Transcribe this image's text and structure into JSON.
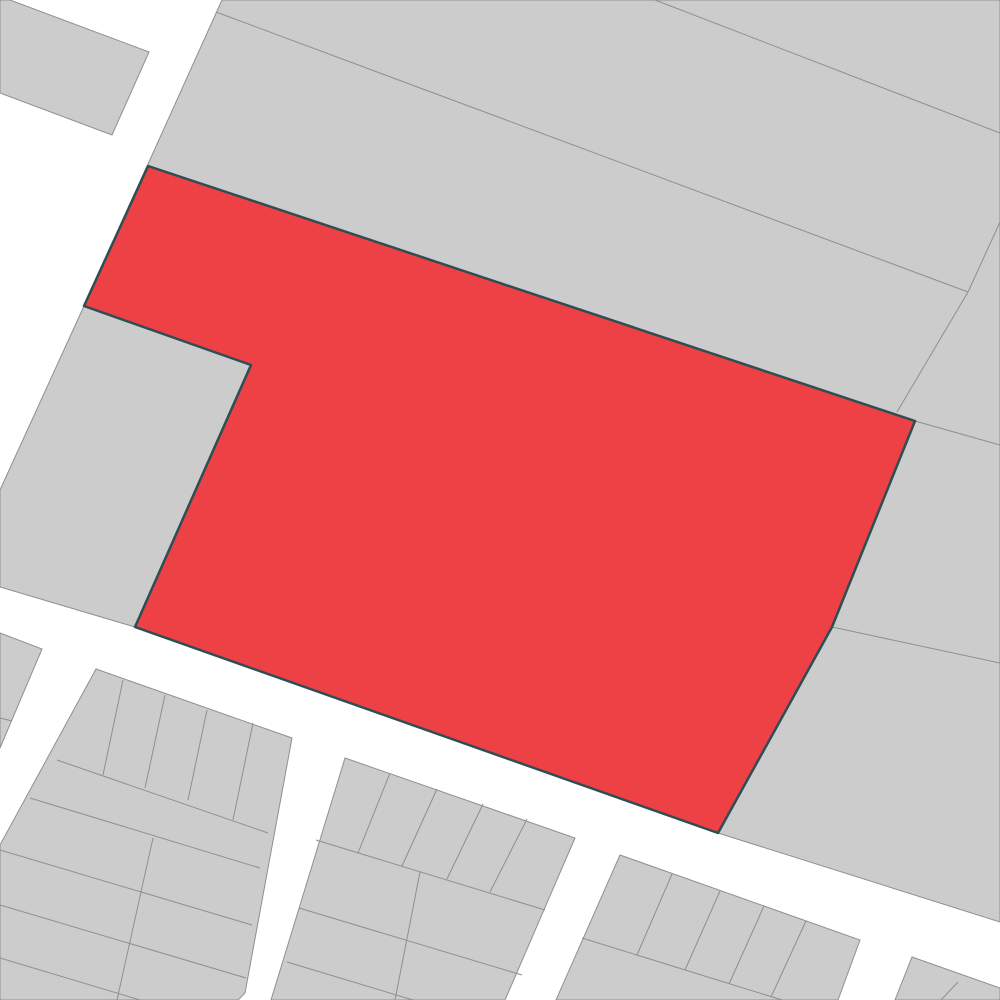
{
  "map": {
    "width": 1000,
    "height": 1000,
    "colors": {
      "street_background": "#ffffff",
      "parcel_fill": "#cccccc",
      "parcel_stroke": "#8f8f8f",
      "parcel_stroke_width": 1,
      "highlight_fill": "#ee4145",
      "highlight_stroke": "#2c4e54",
      "highlight_stroke_width": 2.5
    },
    "parcels": [
      {
        "name": "top-left-parcel",
        "points": [
          [
            10,
            0
          ],
          [
            149,
            52
          ],
          [
            112,
            135
          ],
          [
            0,
            93
          ],
          [
            0,
            0
          ]
        ]
      },
      {
        "name": "north-block",
        "points": [
          [
            222,
            0
          ],
          [
            1000,
            0
          ],
          [
            1000,
            922
          ],
          [
            718,
            833
          ],
          [
            135,
            627
          ],
          [
            0,
            587
          ],
          [
            0,
            490
          ],
          [
            84,
            306
          ]
        ]
      },
      {
        "name": "west-strip-parcel",
        "points": [
          [
            0,
            633
          ],
          [
            42,
            649
          ],
          [
            0,
            748
          ]
        ]
      },
      {
        "name": "southwest-block",
        "points": [
          [
            96,
            669
          ],
          [
            292,
            738
          ],
          [
            245,
            993
          ],
          [
            238,
            1000
          ],
          [
            0,
            1000
          ],
          [
            0,
            845
          ]
        ]
      },
      {
        "name": "south-center-block",
        "points": [
          [
            345,
            758
          ],
          [
            575,
            838
          ],
          [
            505,
            1000
          ],
          [
            271,
            1000
          ]
        ]
      },
      {
        "name": "southeast-block",
        "points": [
          [
            620,
            855
          ],
          [
            860,
            940
          ],
          [
            838,
            1000
          ],
          [
            556,
            1000
          ]
        ]
      },
      {
        "name": "corner-southeast-block",
        "points": [
          [
            912,
            957
          ],
          [
            1000,
            988
          ],
          [
            1000,
            1000
          ],
          [
            895,
            1000
          ]
        ]
      }
    ],
    "boundary_lines": [
      {
        "name": "north-block-divider-1",
        "points": [
          655,
          0,
          1000,
          133
        ]
      },
      {
        "name": "north-block-divider-2",
        "points": [
          216,
          12,
          968,
          292
        ]
      },
      {
        "name": "northeast-corner-edge",
        "points": [
          968,
          292,
          1000,
          222
        ]
      },
      {
        "name": "east-parcel-steep-edge",
        "points": [
          968,
          292,
          897,
          412
        ]
      },
      {
        "name": "east-parcel-divider-a",
        "points": [
          915,
          421,
          1000,
          445
        ]
      },
      {
        "name": "east-parcel-divider-b",
        "points": [
          832,
          627,
          1000,
          663
        ]
      },
      {
        "name": "west-strip-row-line",
        "points": [
          0,
          718,
          12,
          721
        ]
      },
      {
        "name": "southwest-row-line-1",
        "points": [
          57,
          760,
          268,
          833
        ]
      },
      {
        "name": "southwest-row-line-2",
        "points": [
          30,
          798,
          260,
          868
        ]
      },
      {
        "name": "southwest-row-line-3",
        "points": [
          0,
          850,
          252,
          925
        ]
      },
      {
        "name": "southwest-row-line-4",
        "points": [
          0,
          905,
          246,
          978
        ]
      },
      {
        "name": "southwest-row-line-5",
        "points": [
          0,
          958,
          140,
          1000
        ]
      },
      {
        "name": "southwest-lot-divider-1",
        "points": [
          123,
          680,
          103,
          775
        ]
      },
      {
        "name": "southwest-lot-divider-2",
        "points": [
          165,
          695,
          145,
          788
        ]
      },
      {
        "name": "southwest-lot-divider-3",
        "points": [
          207,
          710,
          188,
          800
        ]
      },
      {
        "name": "southwest-lot-divider-4",
        "points": [
          253,
          723,
          233,
          820
        ]
      },
      {
        "name": "southwest-column-divider",
        "points": [
          153,
          838,
          117,
          1000
        ]
      },
      {
        "name": "south-center-row-line-1",
        "points": [
          316,
          840,
          545,
          910
        ]
      },
      {
        "name": "south-center-row-line-2",
        "points": [
          299,
          908,
          522,
          975
        ]
      },
      {
        "name": "south-center-row-line-3",
        "points": [
          287,
          962,
          413,
          1000
        ]
      },
      {
        "name": "south-center-lot-divider-1",
        "points": [
          390,
          773,
          358,
          853
        ]
      },
      {
        "name": "south-center-lot-divider-2",
        "points": [
          437,
          789,
          402,
          866
        ]
      },
      {
        "name": "south-center-lot-divider-3",
        "points": [
          483,
          804,
          447,
          879
        ]
      },
      {
        "name": "south-center-lot-divider-4",
        "points": [
          527,
          819,
          490,
          892
        ]
      },
      {
        "name": "south-center-column-divider",
        "points": [
          420,
          872,
          395,
          1000
        ]
      },
      {
        "name": "southeast-row-line-1",
        "points": [
          582,
          938,
          782,
          1000
        ]
      },
      {
        "name": "southeast-lot-divider-1",
        "points": [
          672,
          874,
          637,
          955
        ]
      },
      {
        "name": "southeast-lot-divider-2",
        "points": [
          720,
          891,
          685,
          970
        ]
      },
      {
        "name": "southeast-lot-divider-3",
        "points": [
          764,
          906,
          729,
          984
        ]
      },
      {
        "name": "southeast-lot-divider-4",
        "points": [
          806,
          921,
          771,
          997
        ]
      },
      {
        "name": "corner-southeast-lot-divider",
        "points": [
          958,
          982,
          941,
          1000
        ]
      }
    ],
    "highlighted_parcel": {
      "name": "highlighted-parcel",
      "points": [
        [
          148,
          166
        ],
        [
          915,
          421
        ],
        [
          832,
          627
        ],
        [
          718,
          833
        ],
        [
          135,
          627
        ],
        [
          251,
          365
        ],
        [
          84,
          306
        ]
      ]
    }
  }
}
